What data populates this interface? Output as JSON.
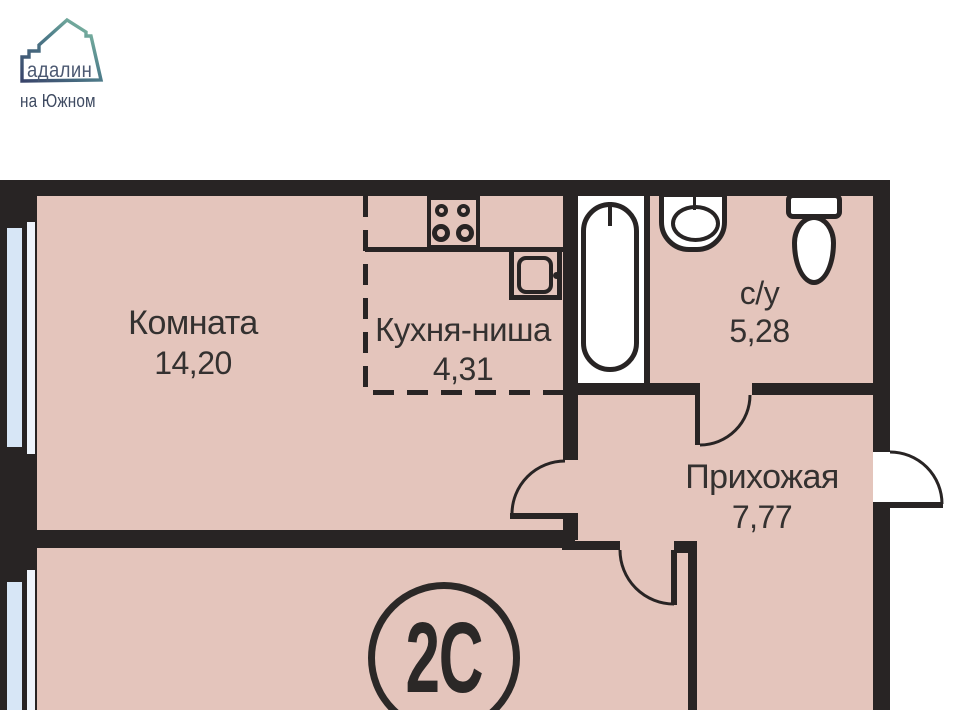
{
  "logo": {
    "brand": "адалин",
    "subtitle": "на Южном"
  },
  "unit": {
    "badge": "2С"
  },
  "rooms": [
    {
      "name": "Комната",
      "area": "14,20"
    },
    {
      "name": "Кухня-ниша",
      "area": "4,31"
    },
    {
      "name": "с/у",
      "area": "5,28"
    },
    {
      "name": "Прихожая",
      "area": "7,77"
    }
  ],
  "icons": [
    "logo-house-icon",
    "window-icon",
    "bathtub-icon",
    "bath-sink-icon",
    "toilet-icon",
    "stove-icon",
    "kitchen-sink-icon",
    "door-swing-icon"
  ],
  "colors": {
    "wall": "#282424",
    "floor": "#e4c5bc",
    "glass": "#d7e6f6",
    "glass_light": "#eef4fc",
    "white": "#ffffff",
    "ink": "#343130",
    "logo_navy": "#38446a",
    "logo_teal": "#8cc9a9",
    "logo_text": "#4b5871"
  }
}
